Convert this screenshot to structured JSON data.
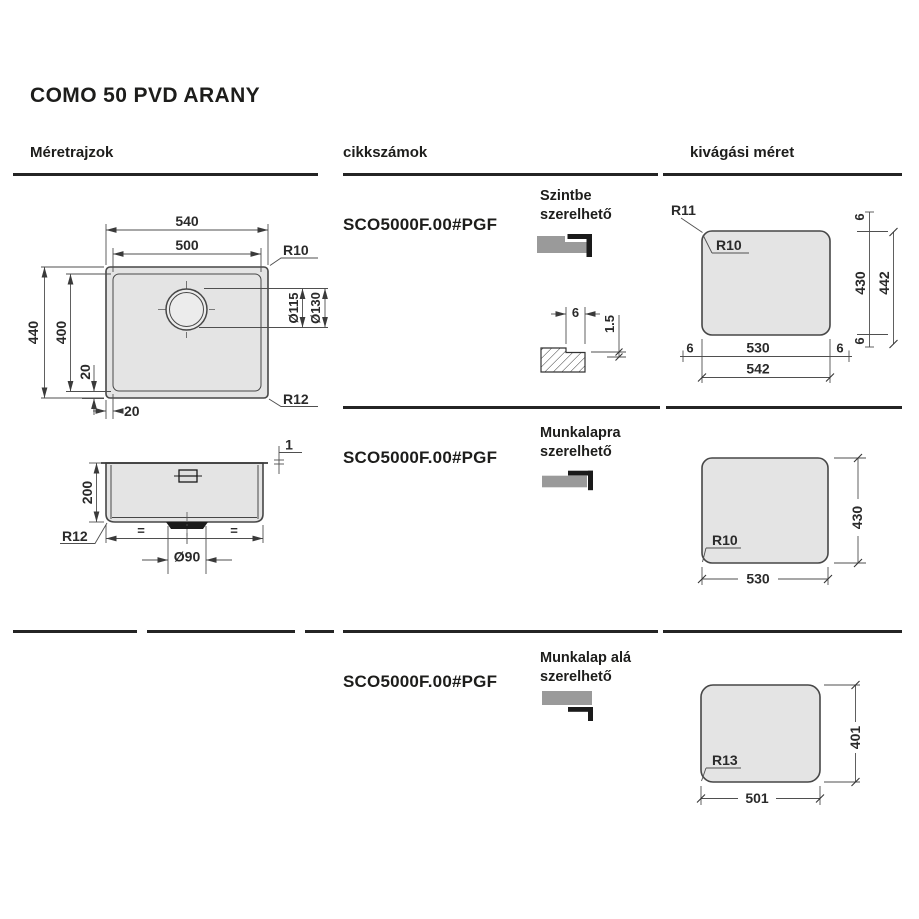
{
  "title": "COMO 50 PVD ARANY",
  "columns": {
    "left": "Méretrajzok",
    "middle": "cikkszámok",
    "right": "kivágási méret"
  },
  "rows": [
    {
      "sku": "SCO5000F.00#PGF",
      "mount_l1": "Szintbe",
      "mount_l2": "szerelhető"
    },
    {
      "sku": "SCO5000F.00#PGF",
      "mount_l1": "Munkalapra",
      "mount_l2": "szerelhető"
    },
    {
      "sku": "SCO5000F.00#PGF",
      "mount_l1": "Munkalap alá",
      "mount_l2": "szerelhető"
    }
  ],
  "drawings": {
    "plan": {
      "w_outer": "540",
      "w_inner": "500",
      "r_tr": "R10",
      "d_inner": "Ø115",
      "d_outer": "Ø130",
      "h_outer": "440",
      "h_inner": "400",
      "off_v": "20",
      "off_h": "20",
      "r_br": "R12"
    },
    "side": {
      "rim": "1",
      "depth": "200",
      "r_bottom": "R12",
      "eq_left": "=",
      "eq_right": "=",
      "drain": "Ø90"
    },
    "detail": {
      "notch_w": "6",
      "notch_d": "1.5"
    },
    "cutout1": {
      "r_outer": "R11",
      "r_inner": "R10",
      "top6": "6",
      "h": "430",
      "h_outer": "442",
      "bot6": "6",
      "left6": "6",
      "w": "530",
      "right6": "6",
      "w_outer": "542"
    },
    "cutout2": {
      "r": "R10",
      "w": "530",
      "h": "430"
    },
    "cutout3": {
      "r": "R13",
      "w": "501",
      "h": "401"
    }
  },
  "colors": {
    "text": "#1d1d1b",
    "line": "#474747",
    "fill_gray": "#e4e4e4",
    "icon_gray": "#9a9a9a",
    "icon_black": "#1a1a1a"
  }
}
